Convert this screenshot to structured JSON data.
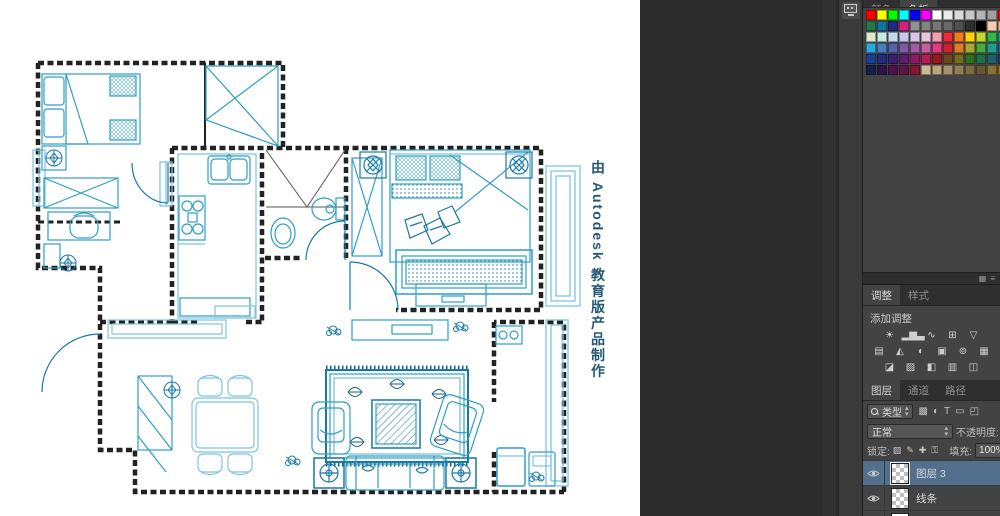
{
  "canvas": {
    "watermark_text": "由 Autodesk 教育版产品制作"
  },
  "dock": {
    "collapsed_panel_button": "properties-panel"
  },
  "panels": {
    "swatches": {
      "tabs": [
        {
          "label": "颜色",
          "active": false
        },
        {
          "label": "色板",
          "active": true
        }
      ],
      "rows": [
        [
          "#ff0000",
          "#ffff00",
          "#00ff00",
          "#00ffff",
          "#0000ff",
          "#ff00ff",
          "#ffffff",
          "#ececec",
          "#dadada",
          "#c8c8c8",
          "#b4b4b4",
          "#a0a0a0",
          "#ff0000"
        ],
        [
          "#1b7a45",
          "#1173a0",
          "#1a2d7a",
          "#d02080",
          "#909090",
          "#838383",
          "#767676",
          "#696969",
          "#4f4f4f",
          "#2e2e2e",
          "#000000",
          "#f7cfae",
          "#f5b78a"
        ],
        [
          "#dde9c9",
          "#c9e9e1",
          "#c1d9ef",
          "#c5c9e9",
          "#d9c5e5",
          "#e9c5d9",
          "#f2a0ae",
          "#ee2a3a",
          "#f47b20",
          "#ffd400",
          "#c3d82e",
          "#35b44a",
          "#00a99d"
        ],
        [
          "#29abe2",
          "#4a7ebe",
          "#5661a9",
          "#7c5aa7",
          "#a15ba3",
          "#c85d9f",
          "#e23a7c",
          "#cc2229",
          "#e07b27",
          "#a8a832",
          "#4ba83c",
          "#1e9e8e",
          "#2a6099"
        ],
        [
          "#1c3e90",
          "#242b79",
          "#3b1f6f",
          "#5d1c67",
          "#8d1c5f",
          "#b11d51",
          "#8f1a1f",
          "#6e451e",
          "#6e6e1e",
          "#2e6e1e",
          "#1e6e46",
          "#1e5c6e",
          "#1e3c6e"
        ],
        [
          "#15204a",
          "#2b1548",
          "#481546",
          "#5e1542",
          "#841530",
          "#cdbb93",
          "#b9a67e",
          "#a5926a",
          "#917e56",
          "#7d6a42",
          "#69562e",
          "#8a6f36",
          "#a0731e"
        ]
      ]
    },
    "group_header": {
      "icons": [
        {
          "name": "panel-grid-icon",
          "glyph": "▦"
        },
        {
          "name": "panel-menu-icon",
          "glyph": "≡"
        }
      ]
    },
    "adjustments": {
      "tabs": [
        {
          "label": "调整",
          "active": true
        },
        {
          "label": "样式",
          "active": false
        }
      ],
      "add_label": "添加调整",
      "icon_rows": [
        [
          {
            "name": "brightness-contrast-icon",
            "glyph": "☀"
          },
          {
            "name": "levels-icon",
            "glyph": "▂▆▃"
          },
          {
            "name": "curves-icon",
            "glyph": "∿"
          },
          {
            "name": "exposure-icon",
            "glyph": "⊞"
          },
          {
            "name": "vibrance-icon",
            "glyph": "▽"
          }
        ],
        [
          {
            "name": "hue-saturation-icon",
            "glyph": "▤"
          },
          {
            "name": "color-balance-icon",
            "glyph": "◭"
          },
          {
            "name": "black-white-icon",
            "glyph": "◐"
          },
          {
            "name": "photo-filter-icon",
            "glyph": "▣"
          },
          {
            "name": "channel-mixer-icon",
            "glyph": "⊚"
          },
          {
            "name": "color-lookup-icon",
            "glyph": "▦"
          }
        ],
        [
          {
            "name": "invert-icon",
            "glyph": "◪"
          },
          {
            "name": "posterize-icon",
            "glyph": "▨"
          },
          {
            "name": "threshold-icon",
            "glyph": "◧"
          },
          {
            "name": "gradient-map-icon",
            "glyph": "▥"
          },
          {
            "name": "selective-color-icon",
            "glyph": "◫"
          }
        ]
      ]
    },
    "layers": {
      "tabs": [
        {
          "label": "图层",
          "active": true
        },
        {
          "label": "通道",
          "active": false
        },
        {
          "label": "路径",
          "active": false
        }
      ],
      "filter": {
        "kind_label": "类型",
        "icons": [
          {
            "name": "filter-pixel-icon",
            "glyph": "▩"
          },
          {
            "name": "filter-adjustment-icon",
            "glyph": "◐"
          },
          {
            "name": "filter-type-icon",
            "glyph": "T"
          },
          {
            "name": "filter-shape-icon",
            "glyph": "▭"
          },
          {
            "name": "filter-smart-object-icon",
            "glyph": "◰"
          }
        ]
      },
      "blend": {
        "mode": "正常",
        "opacity_label": "不透明度:",
        "opacity_value": "100%"
      },
      "lock": {
        "label": "锁定:",
        "icons": [
          {
            "name": "lock-transparency-icon",
            "glyph": "▨"
          },
          {
            "name": "lock-pixels-icon",
            "glyph": "✎"
          },
          {
            "name": "lock-position-icon",
            "glyph": "✚"
          },
          {
            "name": "lock-all-icon",
            "glyph": "⚿"
          }
        ],
        "fill_label": "填充:",
        "fill_value": "100%"
      },
      "items": [
        {
          "name": "图层 3",
          "visible": true,
          "selected": true,
          "thumb": "checker"
        },
        {
          "name": "线条",
          "visible": true,
          "selected": false,
          "thumb": "checker"
        },
        {
          "name": "图层 2",
          "visible": false,
          "selected": false,
          "thumb": "white"
        }
      ]
    }
  },
  "colors": {
    "selected_layer": "#52708c",
    "plan_blue": "#2e9ec7",
    "plan_light": "#7cc5e0",
    "plan_dark": "#1779a8",
    "wall": "#222222"
  }
}
